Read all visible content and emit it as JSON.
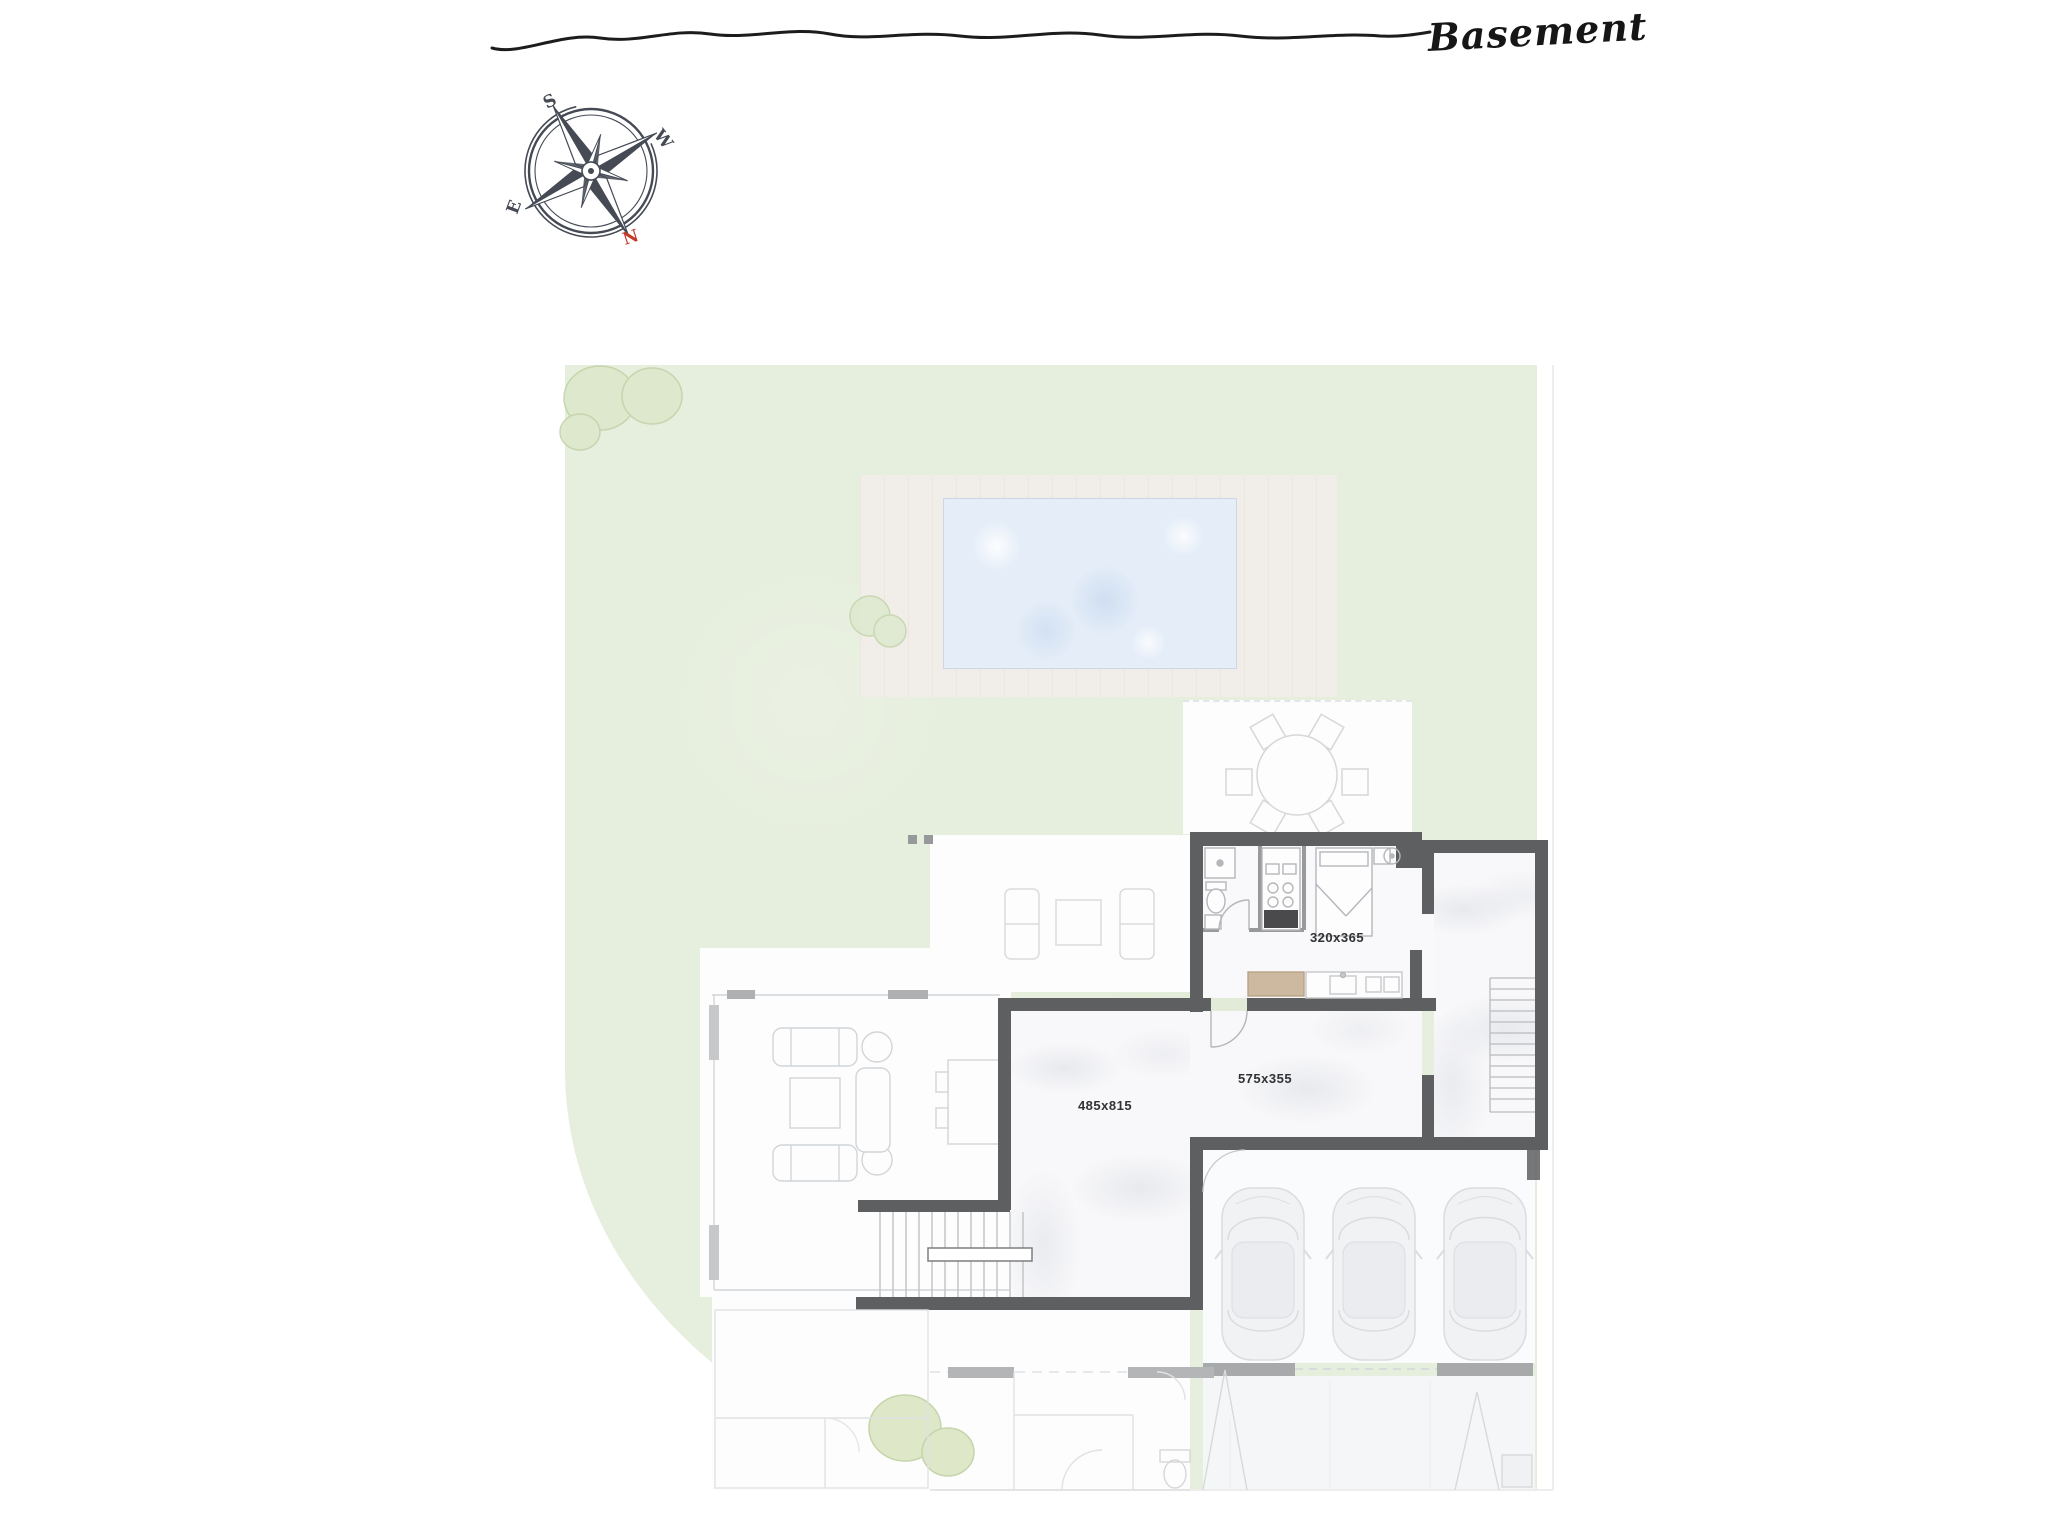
{
  "header": {
    "title": "Basement"
  },
  "compass": {
    "south_label": "S",
    "west_label": "W",
    "north_label": "N",
    "east_label": "E",
    "north_color": "#c13a2a"
  },
  "rooms": {
    "bedroom_suite": {
      "dims": "320x365"
    },
    "main_hall": {
      "dims": "575x355"
    },
    "lower_hall": {
      "dims": "485x815"
    }
  },
  "palette": {
    "garden": "#e6eedd",
    "deck": "#f1eee9",
    "pool": "#e4edf8",
    "wall": "#5e5f60",
    "faded_line": "#d2d5d7"
  }
}
